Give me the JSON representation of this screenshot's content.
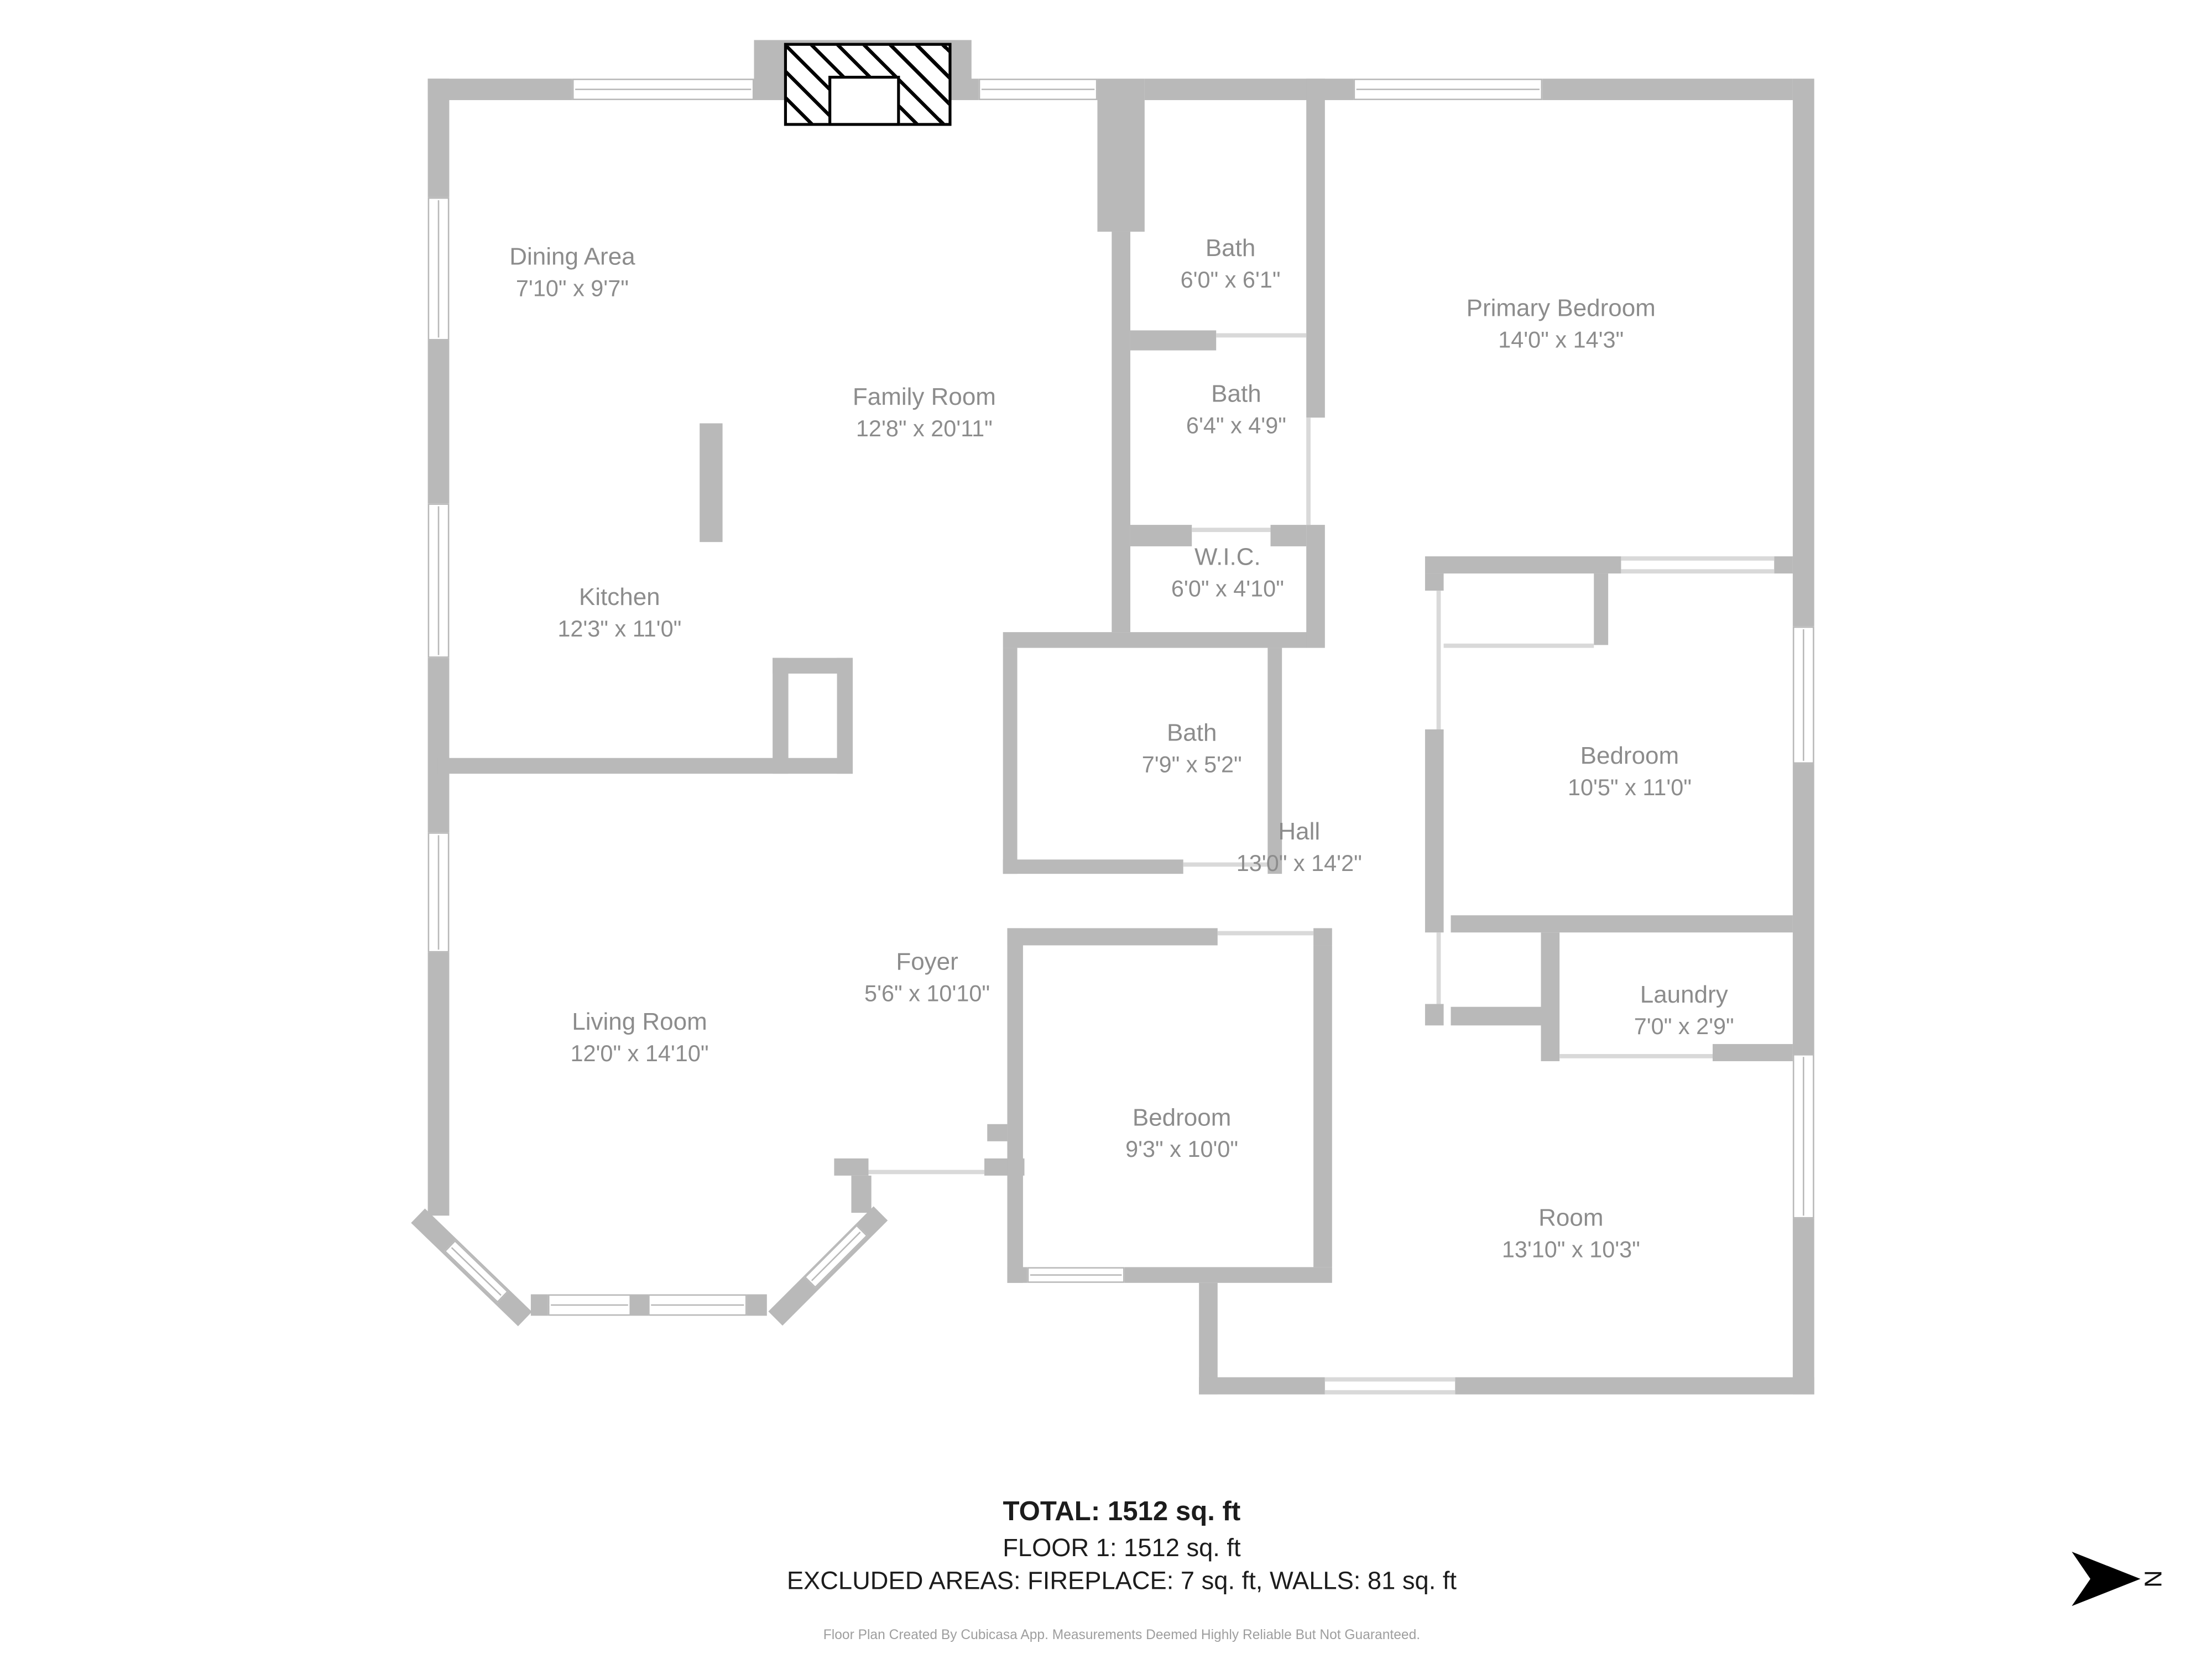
{
  "plan": {
    "rooms": [
      {
        "name": "Dining Area",
        "dims": "7'10\" x 9'7\""
      },
      {
        "name": "Family Room",
        "dims": "12'8\" x 20'11\""
      },
      {
        "name": "Kitchen",
        "dims": "12'3\" x 11'0\""
      },
      {
        "name": "Bath",
        "dims": "6'0\" x 6'1\""
      },
      {
        "name": "Bath",
        "dims": "6'4\" x 4'9\""
      },
      {
        "name": "Primary Bedroom",
        "dims": "14'0\" x 14'3\""
      },
      {
        "name": "W.I.C.",
        "dims": "6'0\" x 4'10\""
      },
      {
        "name": "Bath",
        "dims": "7'9\" x 5'2\""
      },
      {
        "name": "Hall",
        "dims": "13'0\" x 14'2\""
      },
      {
        "name": "Bedroom",
        "dims": "10'5\" x 11'0\""
      },
      {
        "name": "Foyer",
        "dims": "5'6\" x 10'10\""
      },
      {
        "name": "Living Room",
        "dims": "12'0\" x 14'10\""
      },
      {
        "name": "Laundry",
        "dims": "7'0\" x 2'9\""
      },
      {
        "name": "Bedroom",
        "dims": "9'3\" x 10'0\""
      },
      {
        "name": "Room",
        "dims": "13'10\" x 10'3\""
      }
    ],
    "summary": {
      "total": "TOTAL: 1512 sq. ft",
      "floor": "FLOOR 1: 1512 sq. ft",
      "excluded": "EXCLUDED AREAS: FIREPLACE: 7 sq. ft, WALLS: 81 sq. ft"
    },
    "footer": "Floor Plan Created By Cubicasa App. Measurements Deemed Highly Reliable But Not Guaranteed.",
    "compass": {
      "label": "N"
    },
    "colors": {
      "wall": "#b9b9b9",
      "room_label": "#8c8c8c",
      "summary_text": "#1c1c1c",
      "footer_text": "#9e9e9e"
    }
  }
}
